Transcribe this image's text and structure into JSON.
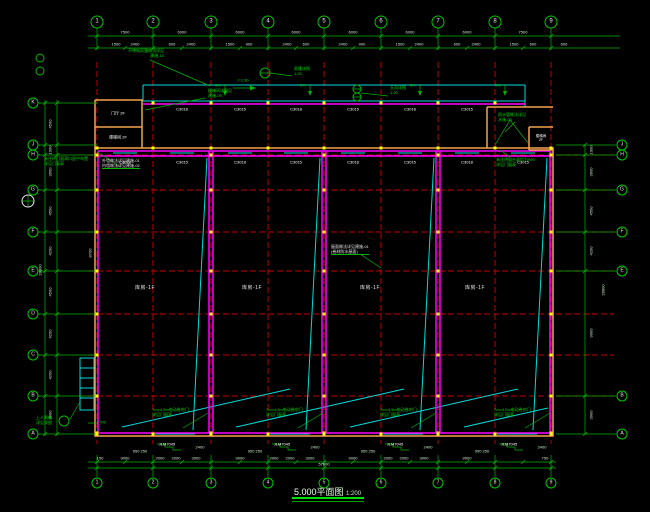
{
  "title": {
    "text": "5.000平面图",
    "scale": "1:200"
  },
  "grid": {
    "cols": [
      "1",
      "2",
      "3",
      "4",
      "5",
      "6",
      "7",
      "8",
      "9"
    ],
    "rows_left": [
      "K",
      "J",
      "H",
      "G",
      "F",
      "E",
      "D",
      "C",
      "B",
      "A"
    ],
    "rows_right": [
      "J",
      "H",
      "G",
      "F",
      "E",
      "B",
      "A"
    ]
  },
  "dims": {
    "top_major": [
      "7500",
      "6000",
      "6000",
      "6000",
      "6000",
      "6000",
      "6000",
      "7500"
    ],
    "top_minor": [
      "1500",
      "2400",
      "600",
      "2400",
      "1500",
      "900",
      "2400",
      "600",
      "2400",
      "900",
      "1500",
      "2400",
      "600",
      "2400",
      "1500",
      "600"
    ],
    "top_right": "600",
    "bottom": [
      "150",
      "9000",
      "2000",
      "2000",
      "3000",
      "9000",
      "2000",
      "2000",
      "3000",
      "9000",
      "2000",
      "2000",
      "3000",
      "9000",
      "750"
    ],
    "bottom_total": "57600",
    "left": [
      "4500",
      "1000",
      "3600",
      "4500",
      "4200",
      "4500",
      "4200",
      "4200",
      "3900"
    ],
    "left_total": "28800",
    "right": [
      "1000",
      "3600",
      "4500",
      "4200",
      "9000",
      "3900"
    ],
    "right_total": "28800",
    "wall_height": "8700",
    "door_width_a": "950 250",
    "door_width_b": "2400",
    "ladder_level": "1.700"
  },
  "tags": {
    "upper_windows": [
      "C3018",
      "C3015",
      "C3018",
      "C3015",
      "C3018",
      "C3015"
    ],
    "windows": [
      "C3018",
      "C3015",
      "C3018",
      "C3015",
      "C3018",
      "C3015",
      "C3018",
      "C3015"
    ],
    "doors": [
      "JLM7045",
      "JLM7045",
      "JLM7045",
      "JLM7045"
    ]
  },
  "rooms": [
    "库房-1F",
    "库房-1F",
    "库房-1F",
    "库房-1F"
  ],
  "slope": {
    "pct": "5%",
    "ramp": "i=1:30"
  },
  "annex": {
    "tl_upper": "门厅 2F",
    "tl_lower": "楼梯间 2F",
    "tr_room": "楼梯间\n2F"
  },
  "annotations": {
    "canopy_note": "不锈钢雨篷做法详见\n建施-10",
    "stair_note": "楼梯间详图见\n建施-09",
    "canopy_detail": "雨篷详图\n1:20",
    "gutter_detail": "天沟详图\n1:20",
    "wall_note": "外墙做法详见建施-01\n内墙做法详见建施-02",
    "opening_note": "未注明门窗洞口居中布置\n详见门窗表",
    "rain_note": "雨水管做法详见\n水施-05",
    "sill_note": "未注明窗台高均为900\n详见门窗表",
    "roof_note": "屋面做法详见建施-01\n(卷材防水屋面)",
    "door_note": "7m×4.5m电动卷帘门\n详见门窗表",
    "ladder_note": "上人爬梯\n详见详图"
  },
  "colors": {
    "grid_red": "#c00000",
    "wall_magenta": "#ff00ff",
    "outer_orange": "#f2a24f",
    "canopy_cyan": "#00dcdc",
    "dim_green": "#00b400",
    "column_yellow": "#ffff00",
    "text_green": "#00dc00",
    "text_white": "#ffffff",
    "title_underline": "#00e100"
  }
}
